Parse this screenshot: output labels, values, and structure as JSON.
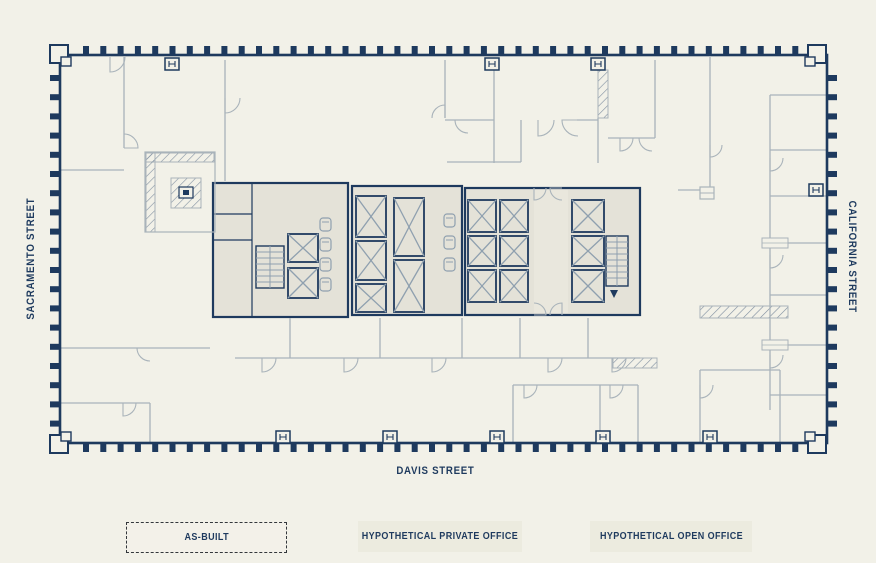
{
  "plan": {
    "streets": {
      "left": "SACRAMENTO STREET",
      "right": "CALIFORNIA STREET",
      "bottom": "DAVIS STREET"
    },
    "colors": {
      "background": "#f2f1e8",
      "wall_navy": "#1e3a5e",
      "core_fill": "#e4e2d8",
      "lobby_fill": "#e9e7dd",
      "elevator_x": "#8fa0af",
      "partition_gray": "#a9b3ba",
      "hatch": "#7f8ea0",
      "button_bg": "#ecebdf",
      "active_button_bg": "#f3f1e9",
      "button_border": "#33373b"
    }
  },
  "toolbar": {
    "buttons": [
      {
        "id": "as-built",
        "label": "AS-BUILT",
        "active": true
      },
      {
        "id": "hypothetical-private-office",
        "label": "HYPOTHETICAL PRIVATE OFFICE",
        "active": false
      },
      {
        "id": "hypothetical-open-office",
        "label": "HYPOTHETICAL OPEN OFFICE",
        "active": false
      }
    ]
  }
}
